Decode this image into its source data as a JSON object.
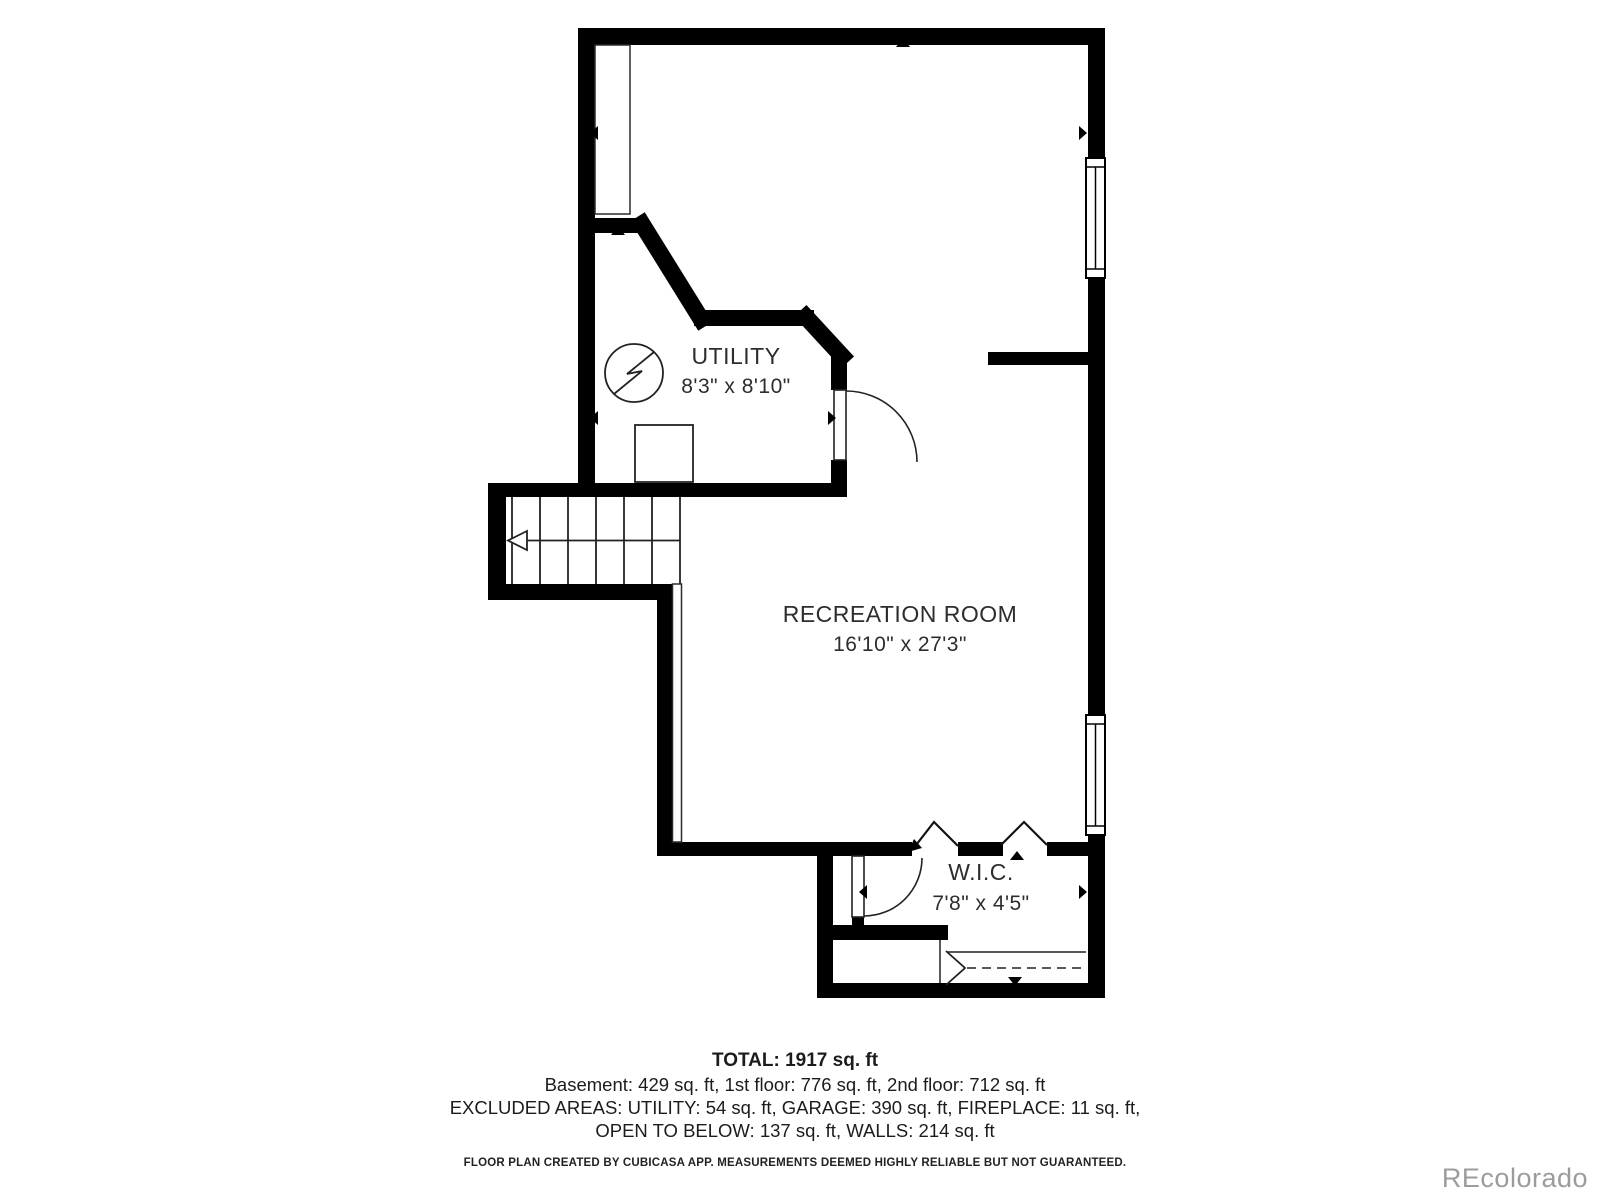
{
  "floor_plan": {
    "rooms": [
      {
        "name": "UTILITY",
        "dimensions": "8'3\" x 8'10\""
      },
      {
        "name": "RECREATION ROOM",
        "dimensions": "16'10\" x 27'3\""
      },
      {
        "name": "W.I.C.",
        "dimensions": "7'8\" x 4'5\""
      }
    ],
    "icons": [
      "water-heater-icon",
      "furnace-icon",
      "stairs-direction-arrow"
    ]
  },
  "summary": {
    "total": "TOTAL: 1917 sq. ft",
    "floors": "Basement: 429 sq. ft, 1st floor: 776 sq. ft, 2nd floor: 712 sq. ft",
    "excluded_line1": "EXCLUDED AREAS: UTILITY: 54 sq. ft, GARAGE: 390 sq. ft, FIREPLACE: 11 sq. ft,",
    "excluded_line2": "OPEN TO BELOW: 137 sq. ft, WALLS: 214 sq. ft"
  },
  "disclaimer": "FLOOR PLAN CREATED BY CUBICASA APP. MEASUREMENTS DEEMED HIGHLY RELIABLE BUT NOT GUARANTEED.",
  "watermark": "REcolorado",
  "colors": {
    "walls": "#000000",
    "label_text": "#2d2d2d",
    "summary_text": "#1c1c1c",
    "watermark": "#9c9c9c",
    "background": "#ffffff"
  }
}
